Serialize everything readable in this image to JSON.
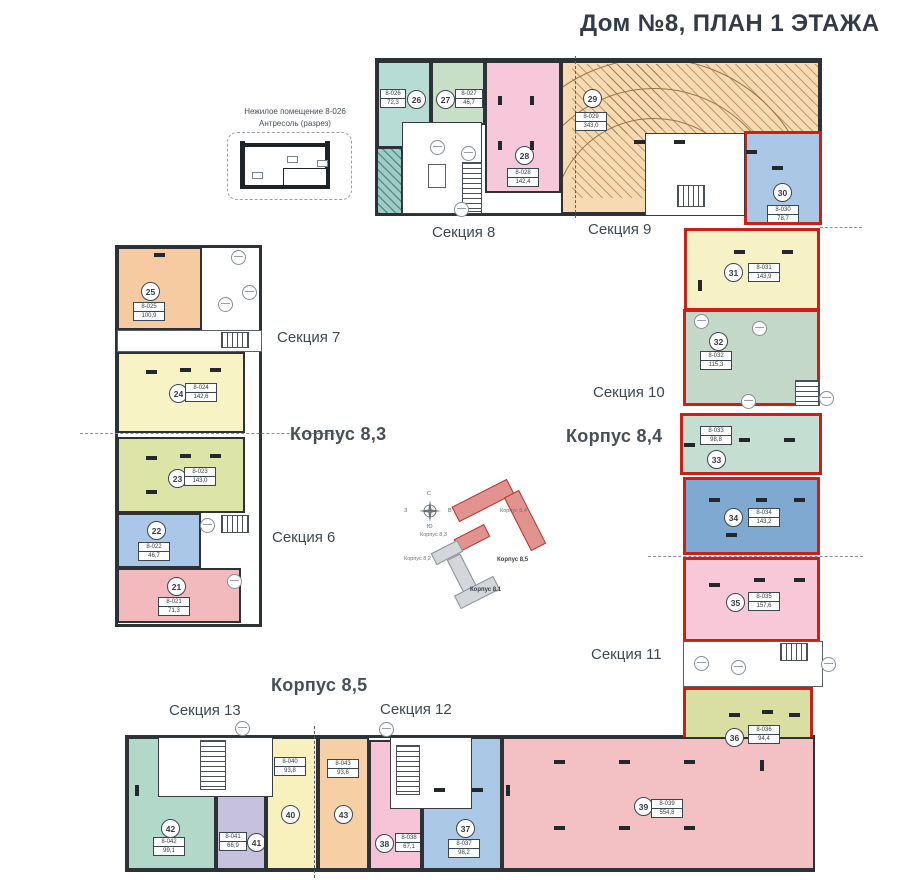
{
  "title": "Дом №8, ПЛАН 1 ЭТАЖА",
  "mezzanine": {
    "line1": "Нежилое помещение 8-026",
    "line2": "Антресоль (разрез)"
  },
  "labels": {
    "section6": "Секция 6",
    "section7": "Секция 7",
    "section8": "Секция 8",
    "section9": "Секция 9",
    "section10": "Секция 10",
    "section11": "Секция 11",
    "section12": "Секция 12",
    "section13": "Секция 13",
    "korpus83": "Корпус 8,3",
    "korpus84": "Корпус 8,4",
    "korpus85": "Корпус 8,5"
  },
  "compass": {
    "north": "С",
    "south": "Ю",
    "west": "З",
    "east": "В"
  },
  "keyplan": {
    "k81": "Корпус 8,1",
    "k82": "Корпус 8,2",
    "k83": "Корпус 8,3",
    "k84": "Корпус 8,4",
    "k85": "Корпус 8,5"
  },
  "colors": {
    "highlight": "#c92018",
    "wall": "#2d3237"
  },
  "units": [
    {
      "num": "21",
      "code": "8-021",
      "area": "71,3",
      "color": "#f3babe"
    },
    {
      "num": "22",
      "code": "8-022",
      "area": "46,7",
      "color": "#aac7e7"
    },
    {
      "num": "23",
      "code": "8-023",
      "area": "143,0",
      "color": "#dde4a7"
    },
    {
      "num": "24",
      "code": "8-024",
      "area": "142,6",
      "color": "#f8f3c5"
    },
    {
      "num": "25",
      "code": "8-025",
      "area": "100,9",
      "color": "#f6cba1"
    },
    {
      "num": "26",
      "code": "8-026",
      "area": "72,3",
      "color": "#b7dcd6"
    },
    {
      "num": "27",
      "code": "8-027",
      "area": "46,7",
      "color": "#c7dfc6"
    },
    {
      "num": "28",
      "code": "8-028",
      "area": "142,4",
      "color": "#f7c8da"
    },
    {
      "num": "29",
      "code": "8-029",
      "area": "343,0",
      "color": "#f7d9b2"
    },
    {
      "num": "30",
      "code": "8-030",
      "area": "78,7",
      "color": "#aac7e5"
    },
    {
      "num": "31",
      "code": "8-031",
      "area": "143,9",
      "color": "#f7f2c5"
    },
    {
      "num": "32",
      "code": "8-032",
      "area": "115,3",
      "color": "#c3d8c7"
    },
    {
      "num": "33",
      "code": "8-033",
      "area": "98,8",
      "color": "#c5ded2"
    },
    {
      "num": "34",
      "code": "8-034",
      "area": "143,2",
      "color": "#7fa9d1"
    },
    {
      "num": "35",
      "code": "8-035",
      "area": "157,6",
      "color": "#f8c7d8"
    },
    {
      "num": "36",
      "code": "8-036",
      "area": "94,4",
      "color": "#d9dfa2"
    },
    {
      "num": "37",
      "code": "8-037",
      "area": "98,2",
      "color": "#abc8e6"
    },
    {
      "num": "38",
      "code": "8-038",
      "area": "67,1",
      "color": "#f7c4d7"
    },
    {
      "num": "39",
      "code": "8-039",
      "area": "554,8",
      "color": "#f3c0c3"
    },
    {
      "num": "40",
      "code": "8-040",
      "area": "93,8",
      "color": "#f8f1bd"
    },
    {
      "num": "41",
      "code": "8-041",
      "area": "66,9",
      "color": "#c6c2dd"
    },
    {
      "num": "42",
      "code": "8-042",
      "area": "99,1",
      "color": "#b2d8ca"
    },
    {
      "num": "43",
      "code": "8-043",
      "area": "93,6",
      "color": "#f6cfa5"
    }
  ]
}
